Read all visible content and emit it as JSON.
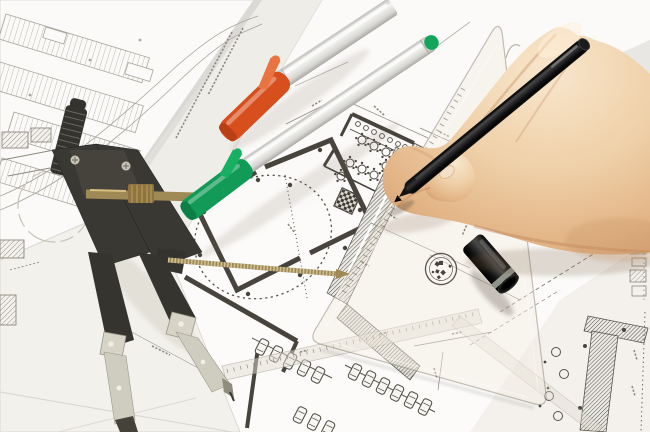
{
  "scene": {
    "type": "photograph",
    "caption": "A hand drafting with a black pen on architectural floor plans, with a compass, orange and green markers, a pen cap and a transparent set square lying on overlapping blueprint sheets",
    "objects": [
      {
        "id": "blueprints",
        "label": "architectural drawing sheets",
        "detail": "site plan with parking rows, floor plan with round tables, room with dashed circle, parking garage with car stalls"
      },
      {
        "id": "compass",
        "label": "drafting compass",
        "detail": "black knurled handle, two legs with metal tips, brass adjustment screws"
      },
      {
        "id": "orange-marker",
        "label": "marker with orange cap",
        "detail": "silver barrel"
      },
      {
        "id": "green-marker",
        "label": "marker with green cap",
        "detail": "silver barrel, green end plug"
      },
      {
        "id": "black-pen",
        "label": "black pen held in hand"
      },
      {
        "id": "pen-cap",
        "label": "black pen cap with grey ring"
      },
      {
        "id": "hand",
        "label": "right hand gripping pen"
      },
      {
        "id": "triangle-ruler",
        "label": "transparent set square with round logo stamp"
      },
      {
        "id": "scale-ruler",
        "label": "translucent scale straightedge"
      }
    ]
  },
  "palette": {
    "paper_bg": "#e9e7e3",
    "sheet_white": "#fbfaf8",
    "sheet_mid": "#f3f1ec",
    "plan_dark": "#46443c",
    "line_site": "#a9a59d",
    "cap_orange": "#d84f1e",
    "cap_orange_light": "#ea7342",
    "cap_green": "#129a57",
    "cap_green_plug": "#13a55c",
    "pen_black": "#141414",
    "cap_ring": "#9aa196",
    "compass_dark": "#34332e",
    "compass_metal": "#d7d3c7",
    "brass": "#9f8a55",
    "skin_light": "#f8e6cc",
    "skin_mid": "#ecc9a0",
    "skin_shadow": "#cf9b6e",
    "nail": "#f4e0c6",
    "ruler_fill": "rgba(242,234,222,0.40)"
  }
}
